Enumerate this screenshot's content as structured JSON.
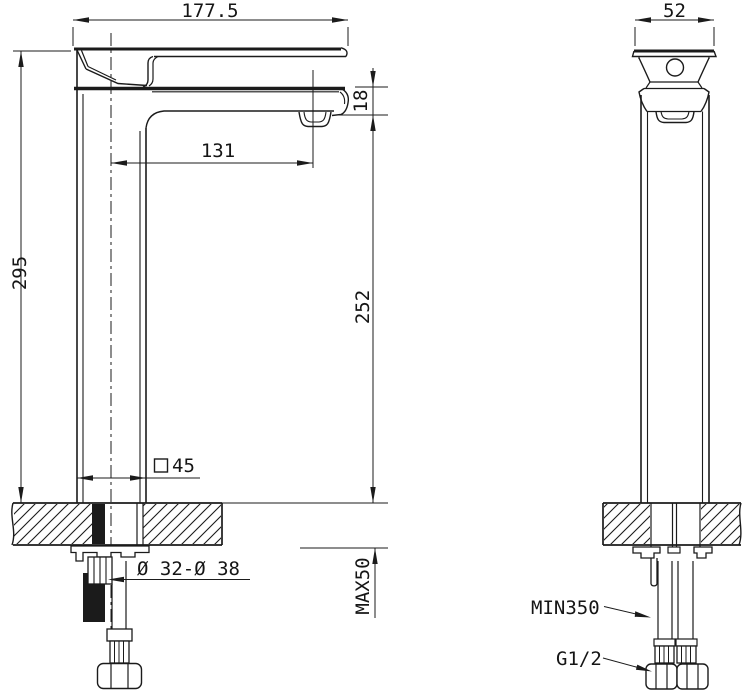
{
  "drawing": {
    "line_color": "#1b1b1b",
    "background": "#ffffff",
    "views": {
      "side_view": "faucet side elevation with mounting counter section",
      "front_view": "faucet front elevation with mounting counter section"
    },
    "dims": {
      "spout_reach": "177.5",
      "overall_height": "295",
      "spout_projection": "131",
      "spout_tip_thickness": "18",
      "outlet_height": "252",
      "body_square_size": "45",
      "mounting_hole": "Ø 32-Ø 38",
      "max_counter_thickness": "MAX50",
      "head_width": "52",
      "min_hose_length": "MIN350",
      "thread_size": "G1/2"
    }
  }
}
